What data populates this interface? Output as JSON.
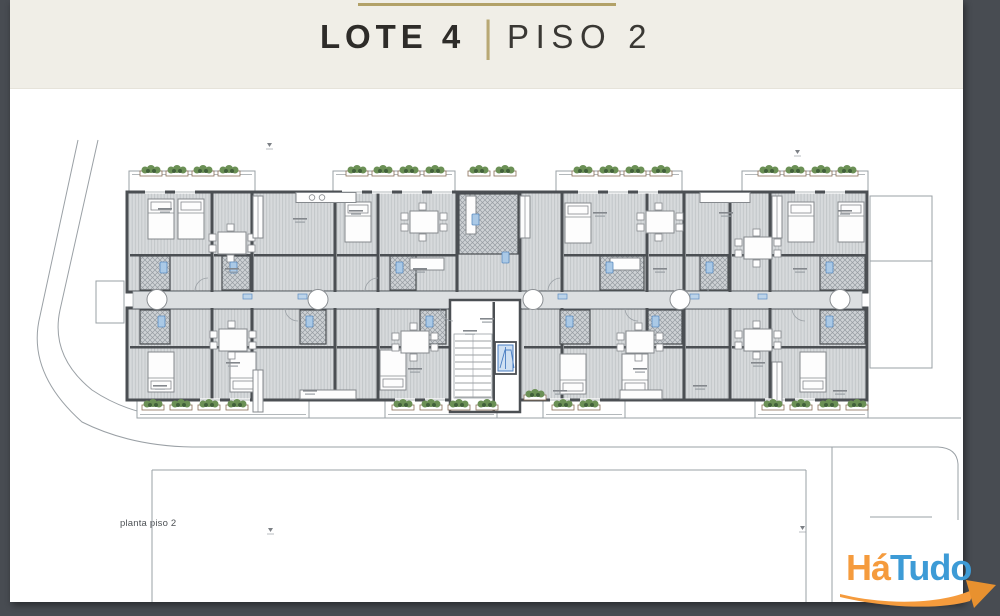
{
  "header": {
    "title": "LOTE 4",
    "separator": "|",
    "subtitle": "PISO 2"
  },
  "plan": {
    "caption": "planta piso 2"
  },
  "logo": {
    "part1": "Há",
    "part2": "Tudo"
  },
  "colors": {
    "frame_dark": "#484c52",
    "header_cream": "#f0eee7",
    "accent_gold": "#b2a168",
    "title_dark": "#2e2c29",
    "plan_wall": "#4b4f53",
    "plan_floor": "#d7dadc",
    "plan_line": "#9aa0a5",
    "plant_green": "#6b9055",
    "fixture_blue": "#aac9e6",
    "elevator_blue": "#4a7ec2",
    "logo_orange": "#f59b3d",
    "logo_blue": "#3d9bd6"
  }
}
